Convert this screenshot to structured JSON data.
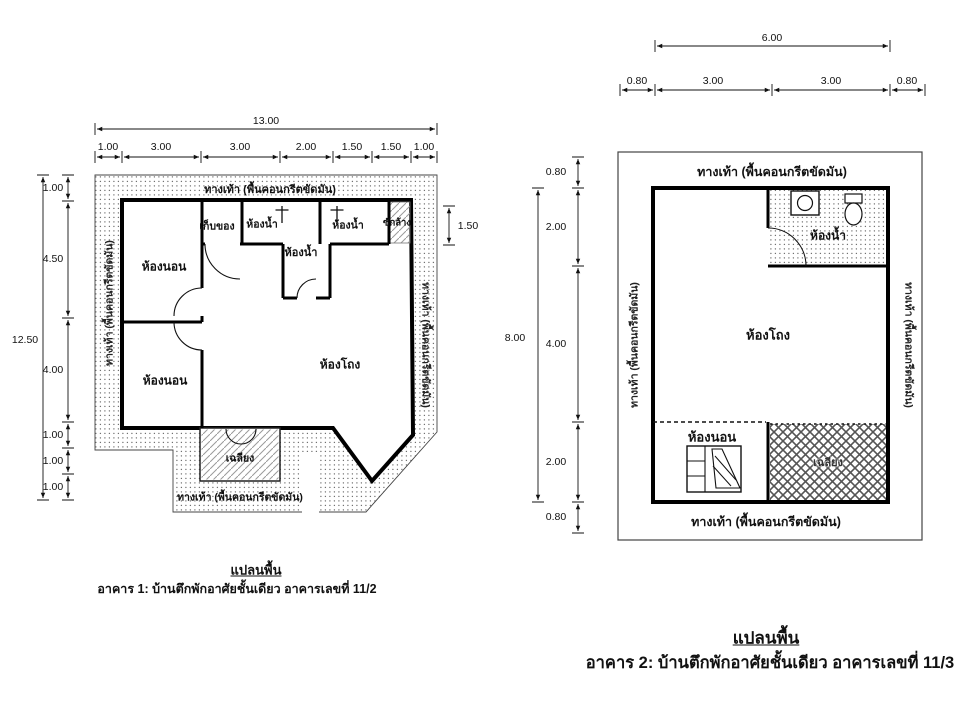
{
  "page": {
    "background": "#ffffff",
    "ink": "#111111"
  },
  "plan1": {
    "caption": {
      "title": "แปลนพื้น",
      "subtitle": "อาคาร 1: บ้านตึกพักอาศัยชั้นเดียว อาคารเลขที่ 11/2"
    },
    "walkway": {
      "top": "ทางเท้า (พื้นคอนกรีตขัดมัน)",
      "bottom": "ทางเท้า (พื้นคอนกรีตขัดมัน)",
      "left": "ทางเท้า (พื้นคอนกรีตขัดมัน)",
      "right": "ทางเท้า (พื้นคอนกรีตขัดมัน)"
    },
    "rooms": {
      "storage": "เก็บของ",
      "bath1": "ห้องน้ำ",
      "bath2": "ห้องน้ำ",
      "bath3": "ห้องน้ำ",
      "laundry": "ซักล้าง",
      "bedroom1": "ห้องนอน",
      "bedroom2": "ห้องนอน",
      "hall": "ห้องโถง",
      "porch": "เฉลียง"
    },
    "dims": {
      "total_width": "13.00",
      "total_height": "12.50",
      "right_side": "1.50",
      "top": [
        "1.00",
        "3.00",
        "3.00",
        "2.00",
        "1.50",
        "1.50",
        "1.00"
      ],
      "left": [
        "1.00",
        "4.50",
        "4.00",
        "1.00",
        "1.00",
        "1.00"
      ]
    }
  },
  "plan2": {
    "caption": {
      "title": "แปลนพื้น",
      "subtitle": "อาคาร 2: บ้านตึกพักอาศัยชั้นเดียว อาคารเลขที่ 11/3"
    },
    "walkway": {
      "top": "ทางเท้า (พื้นคอนกรีตขัดมัน)",
      "bottom": "ทางเท้า (พื้นคอนกรีตขัดมัน)",
      "left": "ทางเท้า (พื้นคอนกรีตขัดมัน)",
      "right": "ทางเท้า (พื้นคอนกรีตขัดมัน)"
    },
    "rooms": {
      "bath": "ห้องน้ำ",
      "hall": "ห้องโถง",
      "bedroom": "ห้องนอน",
      "porch": "เฉลียง"
    },
    "dims": {
      "total_width": "6.00",
      "total_height": "8.00",
      "top": [
        "0.80",
        "3.00",
        "3.00",
        "0.80"
      ],
      "left": [
        "0.80",
        "2.00",
        "4.00",
        "2.00",
        "0.80"
      ]
    }
  }
}
